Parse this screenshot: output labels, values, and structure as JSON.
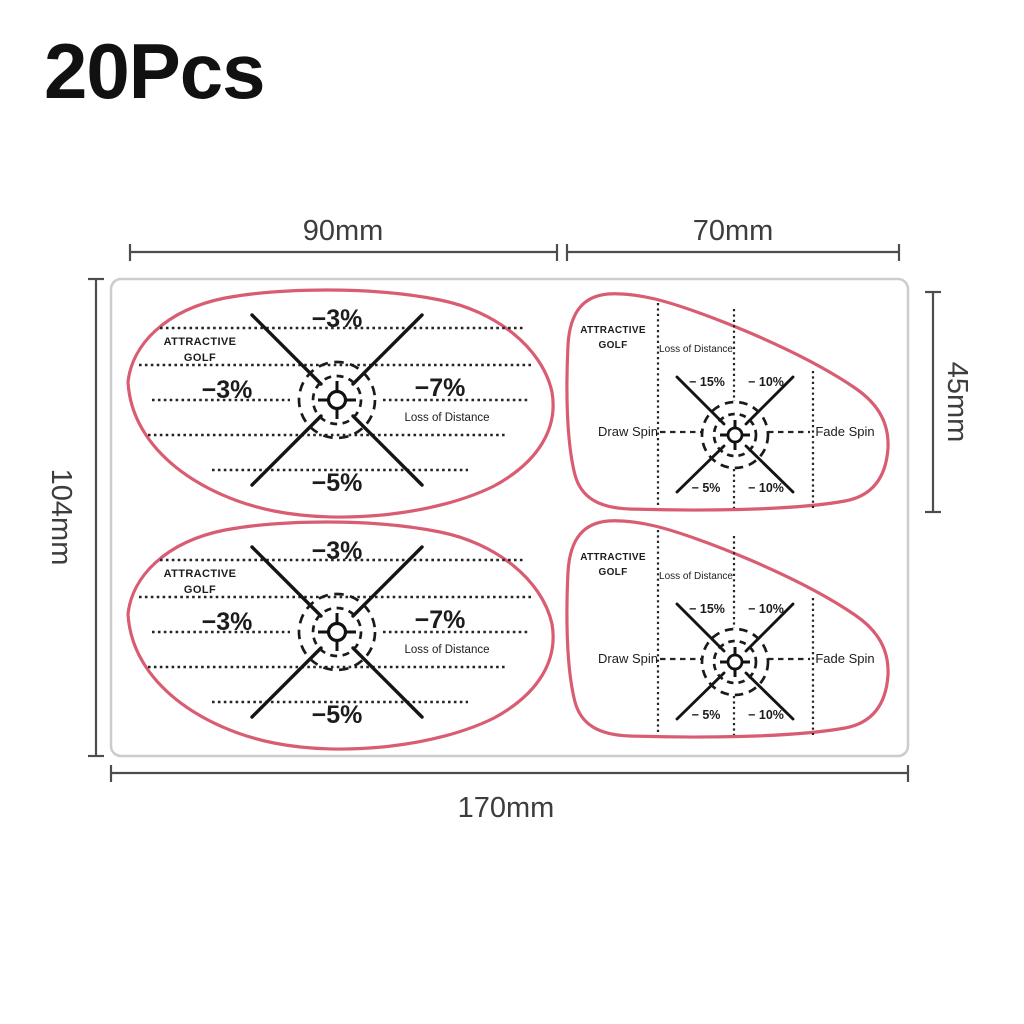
{
  "title": "20Pcs",
  "dimensions": {
    "top_left_width": "90mm",
    "top_right_width": "70mm",
    "left_height": "104mm",
    "right_height": "45mm",
    "bottom_width": "170mm"
  },
  "stickers": {
    "iron": {
      "brand_line1": "ATTRACTIVE",
      "brand_line2": "GOLF",
      "top_label": "−3%",
      "left_label": "−3%",
      "right_label": "−7%",
      "right_sublabel": "Loss of Distance",
      "bottom_label": "−5%"
    },
    "driver": {
      "brand_line1": "ATTRACTIVE",
      "brand_line2": "GOLF",
      "zone_title": "Loss of Distance",
      "top_left_label": "− 15%",
      "top_right_label": "− 10%",
      "left_label": "Draw Spin",
      "right_label": "Fade Spin",
      "bottom_left_label": "− 5%",
      "bottom_right_label": "− 10%"
    }
  },
  "colors": {
    "sticker_outline": "#d95d72",
    "ink": "#1c1c1c",
    "dimension_lines": "#4d4d4d",
    "sheet_border": "#cccccc",
    "background": "#ffffff"
  }
}
